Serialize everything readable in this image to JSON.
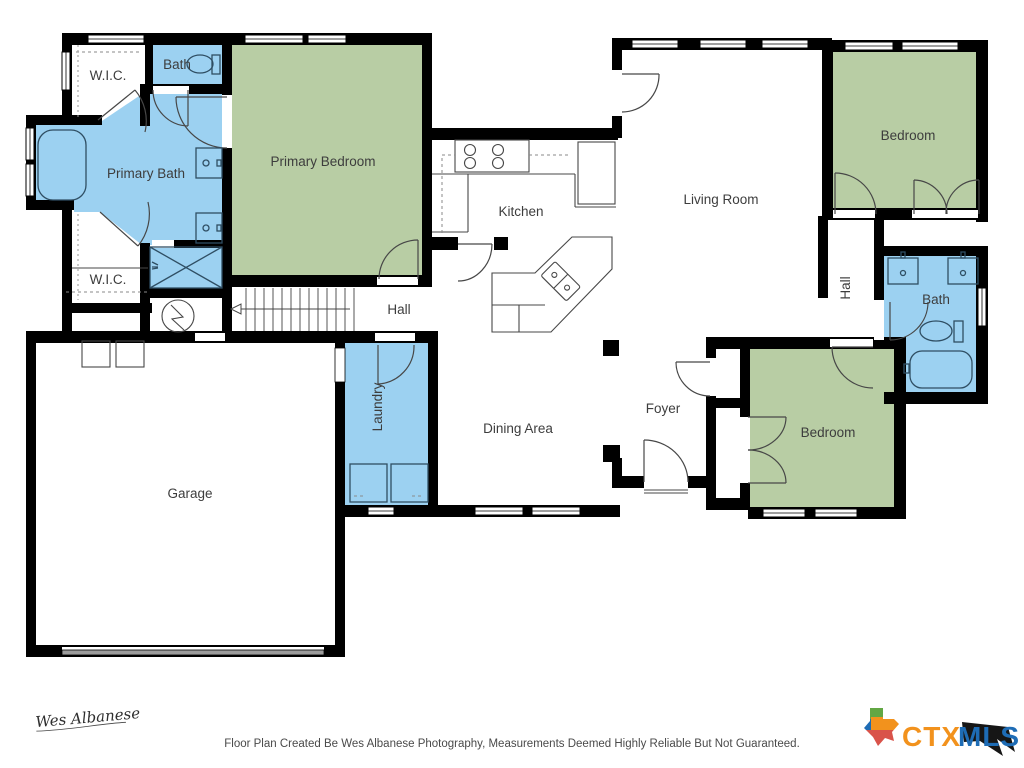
{
  "rooms": {
    "wic_top": "W.I.C.",
    "bath_top": "Bath",
    "primary_bath": "Primary Bath",
    "primary_bedroom": "Primary Bedroom",
    "wic_bottom": "W.I.C.",
    "hall_center": "Hall",
    "kitchen": "Kitchen",
    "living_room": "Living Room",
    "bedroom_top_right": "Bedroom",
    "hall_right": "Hall",
    "bath_right": "Bath",
    "laundry": "Laundry",
    "dining_area": "Dining Area",
    "foyer": "Foyer",
    "bedroom_bottom_right": "Bedroom",
    "garage": "Garage"
  },
  "footer": {
    "disclaimer": "Floor Plan Created Be Wes Albanese Photography, Measurements Deemed Highly Reliable But Not Guaranteed.",
    "signature": "Wes Albanese"
  },
  "logo": {
    "prefix": "CTX",
    "suffix": "MLS"
  },
  "colors": {
    "bedroom_fill": "#b8cda4",
    "bath_fill": "#9cd1f1",
    "wall": "#000000",
    "fixture_stroke": "#2f4e63",
    "label_text": "#3d3d3d",
    "footer_text": "#4a4a4a",
    "logo_orange": "#f2921d",
    "logo_blue": "#1e6cb5",
    "logo_green": "#62a744",
    "logo_red": "#d9534a",
    "logo_black": "#161616",
    "garage_door": "#9c9c9c"
  }
}
